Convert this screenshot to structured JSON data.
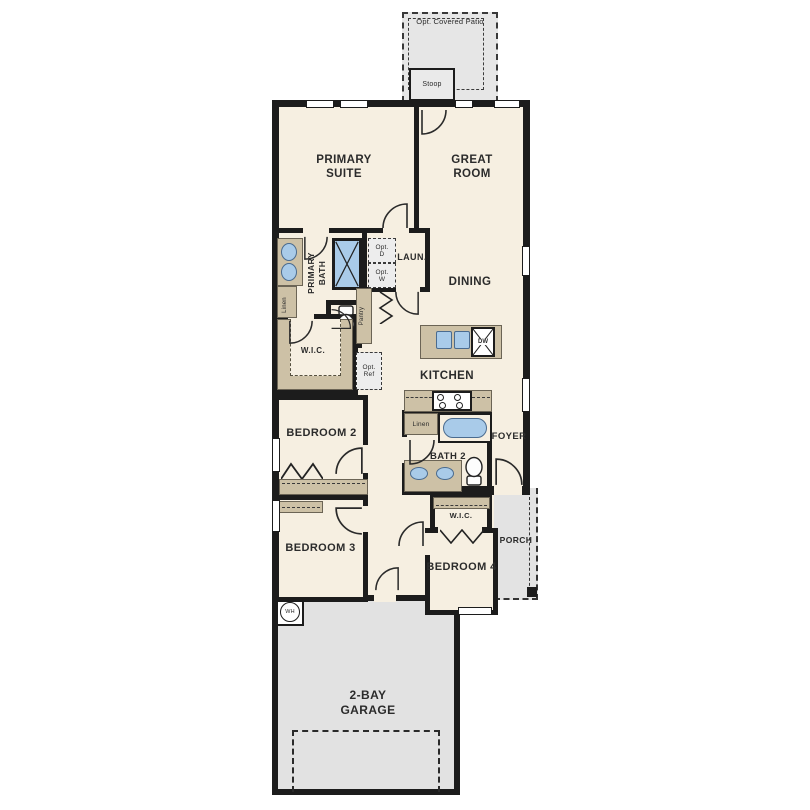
{
  "colors": {
    "room_fill": "#f6efe1",
    "wall": "#1c1c1c",
    "casework_tan": "#cdc1a6",
    "fixture_blue": "#a9cbe9",
    "concrete_gray": "#e3e3e3",
    "label_text": "#2b2b2b"
  },
  "labels": {
    "patio": "Opt. Covered Patio",
    "stoop": "Stoop",
    "primary_suite": "PRIMARY SUITE",
    "great_room": "GREAT ROOM",
    "primary_bath": "PRIMARY BATH",
    "linen_primary": "Linen",
    "laundry": "LAUN.",
    "opt_dryer": "Opt. D",
    "opt_washer": "Opt. W",
    "pantry": "Pantry",
    "wic_primary": "W.I.C.",
    "opt_ref": "Opt. Ref",
    "dining": "DINING",
    "kitchen": "KITCHEN",
    "dishwasher": "DW",
    "linen_bath2": "Linen",
    "bath2": "BATH 2",
    "foyer": "FOYER",
    "bedroom2": "BEDROOM 2",
    "bedroom3": "BEDROOM 3",
    "wic_bedroom4": "W.I.C.",
    "bedroom4": "BEDROOM 4",
    "porch": "PORCH",
    "water_heater": "WH",
    "garage": "2-BAY GARAGE"
  }
}
